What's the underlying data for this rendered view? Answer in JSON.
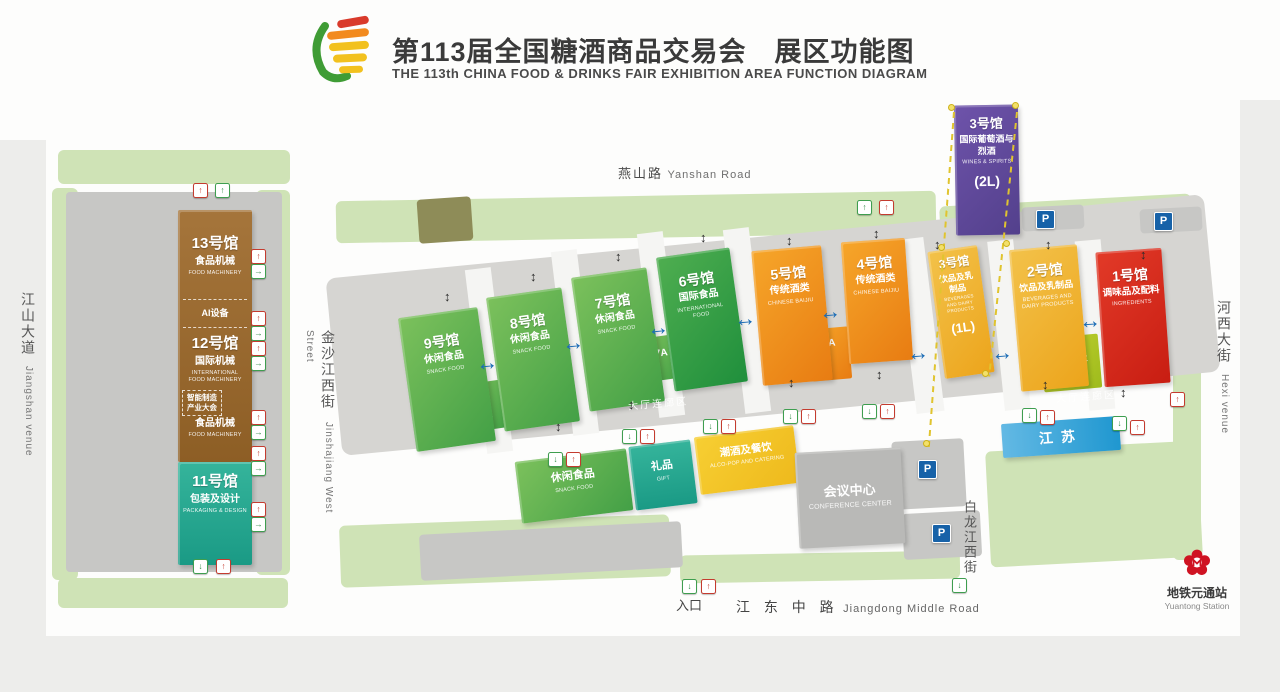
{
  "header": {
    "title_zh": "第113届全国糖酒商品交易会　展区功能图",
    "title_en": "THE 113th CHINA FOOD & DRINKS FAIR EXHIBITION AREA FUNCTION DIAGRAM"
  },
  "roads": {
    "yanshan": {
      "zh": "燕山路",
      "en": "Yanshan Road"
    },
    "jiangdong": {
      "zh": "江 东 中 路",
      "en": "Jiangdong Middle Road"
    },
    "jinshajiang": {
      "zh": "金沙江西街",
      "en": "Jinshajiang West Street"
    },
    "bailongjiang": {
      "zh": "白龙江西街"
    },
    "jiangshan": {
      "zh": "江山大道",
      "en": "Jiangshan venue"
    },
    "hexi": {
      "zh": "河西大街",
      "en": "Hexi venue"
    }
  },
  "halls": {
    "h13": {
      "name": "13号馆",
      "zh": "食品机械",
      "en": "FOOD MACHINERY"
    },
    "ai": {
      "label": "AI设备"
    },
    "h12": {
      "name": "12号馆",
      "zh": "国际机械",
      "en": "INTERNATIONAL FOOD MACHINERY"
    },
    "smart": {
      "line1": "智能制造",
      "line2": "产业大会"
    },
    "h12b": {
      "zh": "食品机械",
      "en": "FOOD MACHINERY"
    },
    "h11": {
      "name": "11号馆",
      "zh": "包装及设计",
      "en": "PACKAGING & DESIGN"
    },
    "h9": {
      "name": "9号馆",
      "zh": "休闲食品",
      "en": "SNACK FOOD"
    },
    "a9": "9A",
    "h8": {
      "name": "8号馆",
      "zh": "休闲食品",
      "en": "SNACK FOOD"
    },
    "h7": {
      "name": "7号馆",
      "zh": "休闲食品",
      "en": "SNACK FOOD"
    },
    "a7": "7A",
    "h6": {
      "name": "6号馆",
      "zh": "国际食品",
      "en": "INTERNATIONAL FOOD"
    },
    "h5": {
      "name": "5号馆",
      "zh": "传统酒类",
      "en": "CHINESE BAIJIU"
    },
    "a5": "5A",
    "h4": {
      "name": "4号馆",
      "zh": "传统酒类",
      "en": "CHINESE BAIJIU"
    },
    "h3u": {
      "name": "3号馆",
      "zh": "国际葡萄酒与烈酒",
      "en": "WINES & SPIRITS",
      "level": "(2L)"
    },
    "h3l": {
      "name": "3号馆",
      "zh": "饮品及乳制品",
      "en": "BEVERAGES AND DAIRY PRODUCTS",
      "level": "(1L)"
    },
    "h2": {
      "name": "2号馆",
      "zh": "饮品及乳制品",
      "en": "BEVERAGES AND DAIRY PRODUCTS"
    },
    "a2": {
      "name": "2A",
      "zh": "绿色农业",
      "note": "（乡村振兴）"
    },
    "h1": {
      "name": "1号馆",
      "zh": "调味品及配料",
      "en": "INGREDIENTS"
    },
    "jiangsu": "江苏",
    "snack": {
      "zh": "休闲食品",
      "en": "SNACK FOOD"
    },
    "gift": {
      "zh": "礼品",
      "en": "GIFT"
    },
    "alcopop": {
      "zh": "潮酒及餐饮",
      "en": "ALCO-POP AND CATERING"
    },
    "conference": {
      "zh": "会议中心",
      "en": "CONFERENCE CENTER"
    }
  },
  "labels": {
    "corridor": "大厅连廊区",
    "entrance": "入口",
    "parking": "P",
    "metro_zh": "地铁元通站",
    "metro_en": "Yuantong Station"
  },
  "icons": {
    "exit": "↑",
    "enter": "↓",
    "door": "→",
    "arrow_h": "↔",
    "arrow_v": "↕"
  },
  "colors": {
    "hall_green": "#5cb04a",
    "hall_dark_green": "#2f9e44",
    "hall_orange": "#f18a1d",
    "hall_gold": "#f0b32c",
    "hall_red": "#d8251c",
    "hall_purple": "#5f4596",
    "hall_teal": "#23a38c",
    "hall_brown": "#9a6a2f",
    "jiangsu_blue": "#2a9fd6",
    "parking_blue": "#1762a8",
    "metro_red": "#cf1322"
  }
}
